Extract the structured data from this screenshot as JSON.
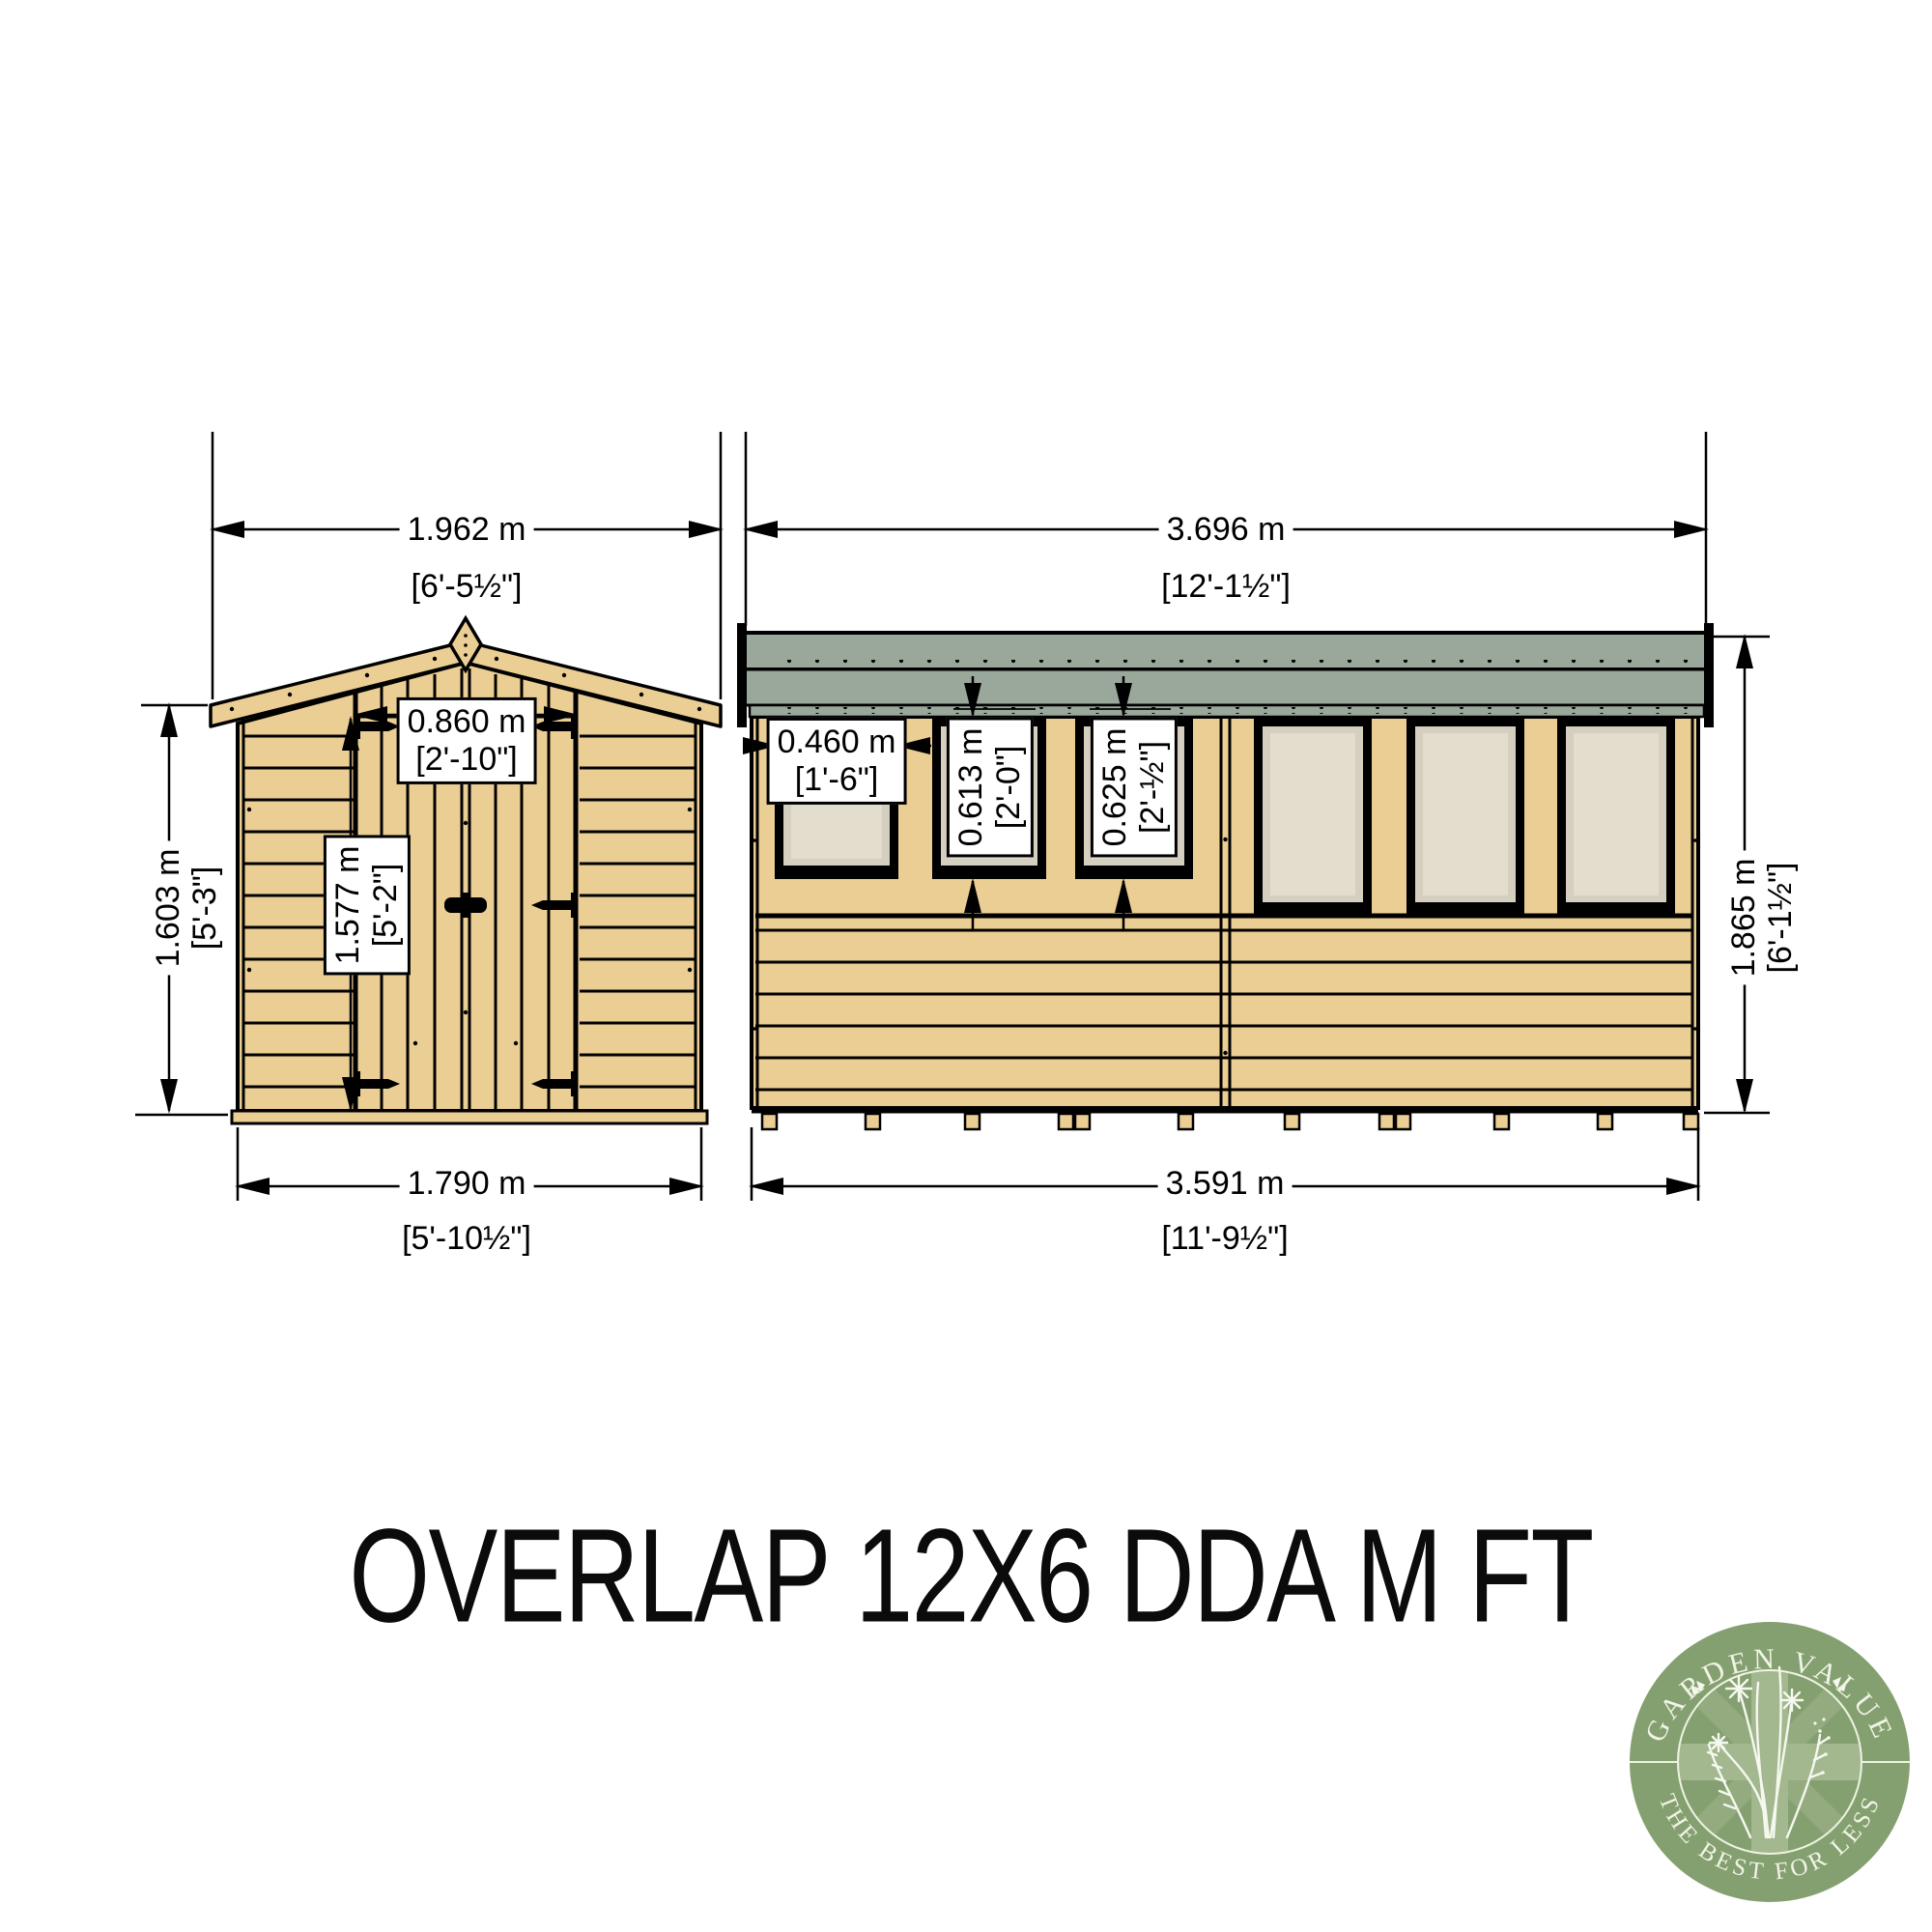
{
  "title": "OVERLAP 12X6 DDA M FT",
  "front": {
    "roof_width_m": "1.962 m",
    "roof_width_ft": "[6'-5½\"]",
    "wall_height_m": "1.603 m",
    "wall_height_ft": "[5'-3\"]",
    "door_width_m": "0.860 m",
    "door_width_ft": "[2'-10\"]",
    "door_height_m": "1.577 m",
    "door_height_ft": "[5'-2\"]",
    "base_width_m": "1.790 m",
    "base_width_ft": "[5'-10½\"]"
  },
  "side": {
    "roof_length_m": "3.696 m",
    "roof_length_ft": "[12'-1½\"]",
    "window_width_m": "0.460 m",
    "window_width_ft": "[1'-6\"]",
    "window_height_a_m": "0.613 m",
    "window_height_a_ft": "[2'-0\"]",
    "window_height_b_m": "0.625 m",
    "window_height_b_ft": "[2'-½\"]",
    "wall_height_m": "1.865 m",
    "wall_height_ft": "[6'-1½\"]",
    "base_length_m": "3.591 m",
    "base_length_ft": "[11'-9½\"]"
  },
  "logo": {
    "arc_top": "GARDEN VALUE",
    "arc_bottom": "THE BEST FOR LESS"
  },
  "colors": {
    "wood": "#ebce93",
    "roof_grey": "#9aa89b",
    "glazing": "#e3ddce",
    "glazing_surround": "#d5cfc0",
    "logo_green": "#85a070",
    "logo_band": "#a3b88e",
    "ink": "#000000"
  }
}
